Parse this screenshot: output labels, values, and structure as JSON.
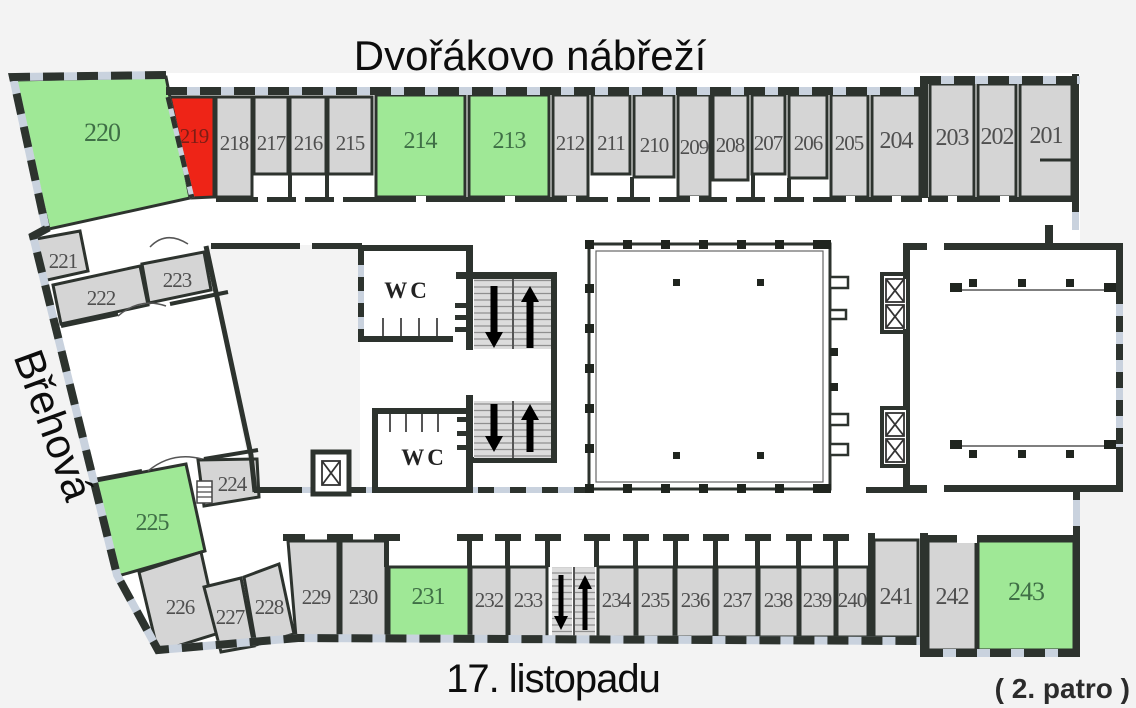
{
  "streets": {
    "top": "Dvořákovo nábřeží",
    "left": "Břehová",
    "bottom": "17. listopadu"
  },
  "floor_note": "( 2. patro )",
  "labels": {
    "wc": "WC"
  },
  "icons": {
    "stairs_up_arrow": "↑",
    "stairs_down_arrow": "↓",
    "elevator": "⊠"
  },
  "colors": {
    "background": "#f3f3f3",
    "interior": "#ffffff",
    "wall": "#2d332e",
    "window": "#c9d2de",
    "room_gray": "#d5d5d5",
    "room_green": "#9fe896",
    "room_red": "#ee2417"
  },
  "rooms": {
    "r201": {
      "number": "201",
      "type": "gray"
    },
    "r202": {
      "number": "202",
      "type": "gray"
    },
    "r203": {
      "number": "203",
      "type": "gray"
    },
    "r204": {
      "number": "204",
      "type": "gray"
    },
    "r205": {
      "number": "205",
      "type": "gray"
    },
    "r206": {
      "number": "206",
      "type": "gray"
    },
    "r207": {
      "number": "207",
      "type": "gray"
    },
    "r208": {
      "number": "208",
      "type": "gray"
    },
    "r209": {
      "number": "209",
      "type": "gray"
    },
    "r210": {
      "number": "210",
      "type": "gray"
    },
    "r211": {
      "number": "211",
      "type": "gray"
    },
    "r212": {
      "number": "212",
      "type": "gray"
    },
    "r213": {
      "number": "213",
      "type": "green"
    },
    "r214": {
      "number": "214",
      "type": "green"
    },
    "r215": {
      "number": "215",
      "type": "gray"
    },
    "r216": {
      "number": "216",
      "type": "gray"
    },
    "r217": {
      "number": "217",
      "type": "gray"
    },
    "r218": {
      "number": "218",
      "type": "gray"
    },
    "r219": {
      "number": "219",
      "type": "red"
    },
    "r220": {
      "number": "220",
      "type": "green"
    },
    "r221": {
      "number": "221",
      "type": "gray"
    },
    "r222": {
      "number": "222",
      "type": "gray"
    },
    "r223": {
      "number": "223",
      "type": "gray"
    },
    "r224": {
      "number": "224",
      "type": "gray"
    },
    "r225": {
      "number": "225",
      "type": "green"
    },
    "r226": {
      "number": "226",
      "type": "gray"
    },
    "r227": {
      "number": "227",
      "type": "gray"
    },
    "r228": {
      "number": "228",
      "type": "gray"
    },
    "r229": {
      "number": "229",
      "type": "gray"
    },
    "r230": {
      "number": "230",
      "type": "gray"
    },
    "r231": {
      "number": "231",
      "type": "green"
    },
    "r232": {
      "number": "232",
      "type": "gray"
    },
    "r233": {
      "number": "233",
      "type": "gray"
    },
    "r234": {
      "number": "234",
      "type": "gray"
    },
    "r235": {
      "number": "235",
      "type": "gray"
    },
    "r236": {
      "number": "236",
      "type": "gray"
    },
    "r237": {
      "number": "237",
      "type": "gray"
    },
    "r238": {
      "number": "238",
      "type": "gray"
    },
    "r239": {
      "number": "239",
      "type": "gray"
    },
    "r240": {
      "number": "240",
      "type": "gray"
    },
    "r241": {
      "number": "241",
      "type": "gray"
    },
    "r242": {
      "number": "242",
      "type": "gray"
    },
    "r243": {
      "number": "243",
      "type": "green"
    }
  }
}
